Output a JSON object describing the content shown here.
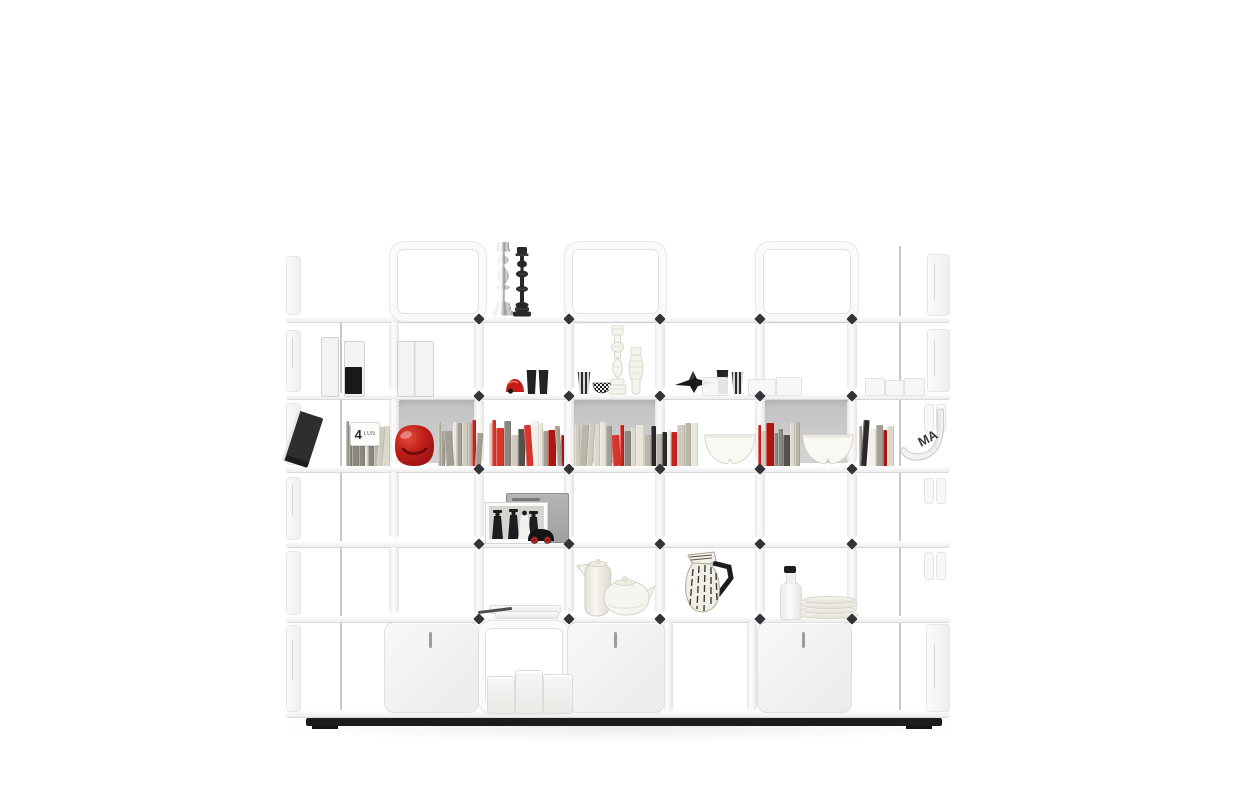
{
  "meta": {
    "scene": "White modular cube shelving unit (product-photo style) on a white background, styled with books, ceramics and decorative objects",
    "shelf_rows": 6,
    "shelf_material": "white folded sheet metal"
  },
  "labels": {
    "calendar_day": "4",
    "calendar_weekday": "LUN",
    "magazine_letters": "MA"
  },
  "palette": {
    "background": "#ffffff",
    "frame_white": "#fafafa",
    "frame_edge": "#e2e2e2",
    "shelf_shadow": "#d9d9d9",
    "back_panel_gray": "#c9c9c9",
    "base_black": "#1c1c1e",
    "connector_black": "#33333a",
    "accent_red": "#c2201a",
    "object_black": "#232326",
    "ceramic_cream": "#f3f1ea"
  },
  "books": {
    "baseline": 466,
    "hmin": 30,
    "hmax": 46,
    "creams": [
      "#f2f0e9",
      "#e8e5db",
      "#dcd8cc",
      "#cfcbbf",
      "#bab6aa",
      "#a39f94",
      "#8b887f"
    ],
    "darks": [
      "#3a3833",
      "#2b2a27",
      "#55524b"
    ],
    "reds": [
      "#c9231c",
      "#b01410",
      "#d8352c"
    ],
    "groups": [
      {
        "x": 346,
        "width": 44,
        "seed": 11,
        "red": 0.08,
        "dark": 0.08
      },
      {
        "x": 438,
        "width": 46,
        "seed": 22,
        "red": 0.06,
        "dark": 0.05
      },
      {
        "x": 489,
        "width": 78,
        "seed": 33,
        "red": 0.22,
        "dark": 0.1
      },
      {
        "x": 572,
        "width": 126,
        "seed": 44,
        "red": 0.16,
        "dark": 0.12
      },
      {
        "x": 758,
        "width": 42,
        "seed": 55,
        "red": 0.18,
        "dark": 0.06
      },
      {
        "x": 859,
        "width": 38,
        "seed": 66,
        "red": 0.1,
        "dark": 0.28
      }
    ]
  },
  "objects": [
    "silver candlestick",
    "black candlestick",
    "glass cylinder vases",
    "black cylinder vase",
    "red toy",
    "black cups",
    "striped cup",
    "checkered bowl",
    "white carved candlestick",
    "white carved vase",
    "black airplane sculpture",
    "translucent boxes",
    "calendar card",
    "leaning black book",
    "red glossy bag",
    "rows of books",
    "white split bowls",
    "rolled magazine",
    "black and white wedding photo",
    "gray box",
    "black toy car with red wheels",
    "white trays",
    "pen",
    "white coffee pot",
    "white teapot",
    "striped jug with black handle",
    "white bottle with black cap",
    "stack of white plates",
    "white canisters",
    "cabinet doors with slot handles",
    "black plinth base"
  ]
}
